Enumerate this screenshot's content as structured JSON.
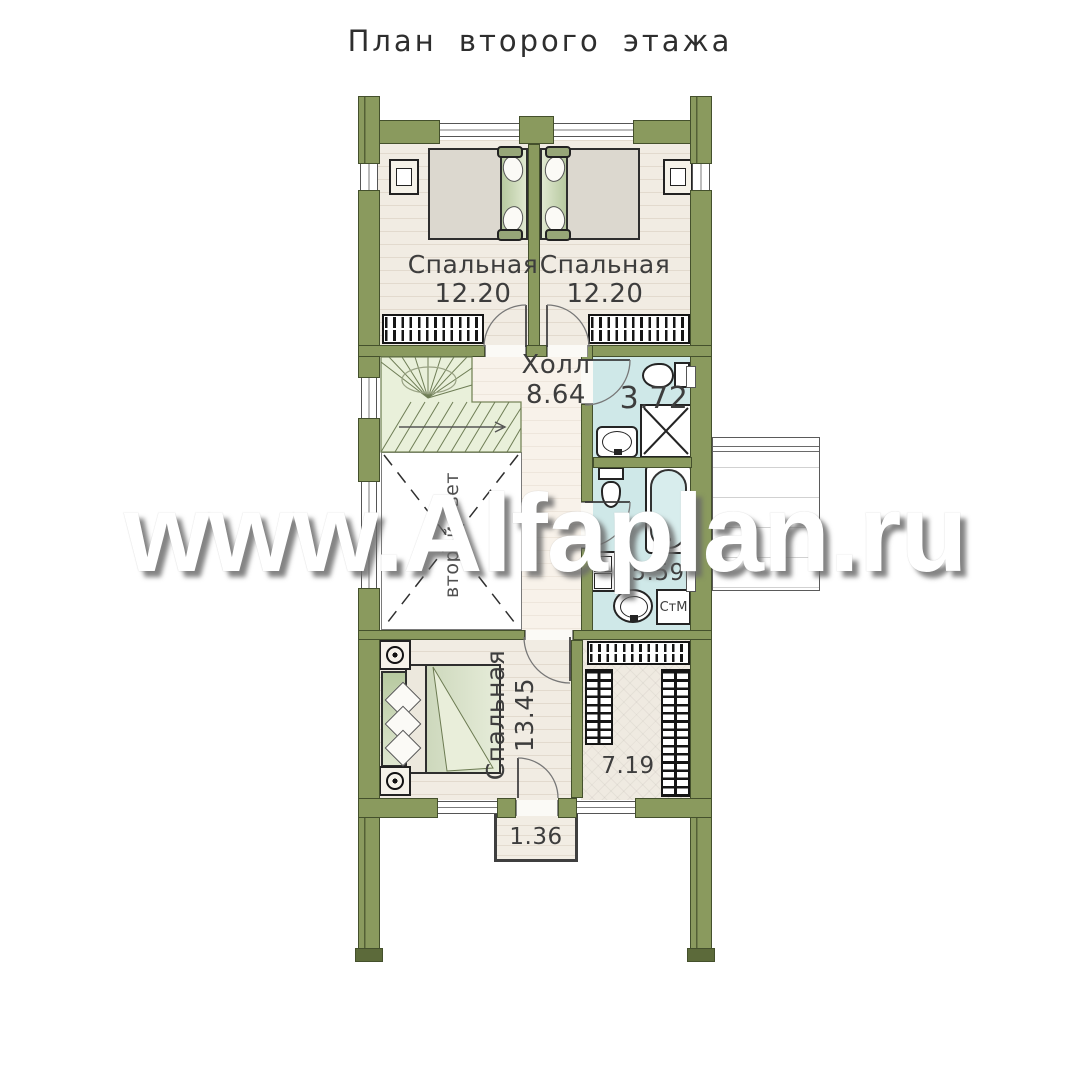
{
  "title": "План второго этажа",
  "watermark": "www.Alfaplan.ru",
  "rooms": {
    "bedroom_top_left": {
      "label": "Спальная",
      "area": "12.20"
    },
    "bedroom_top_right": {
      "label": "Спальная",
      "area": "12.20"
    },
    "hall": {
      "label": "Холл",
      "area": "8.64"
    },
    "bathroom_upper": {
      "area": "3.72"
    },
    "bathroom_lower": {
      "area": "5.59",
      "appliance_label": "СтМ"
    },
    "bedroom_lower": {
      "label": "Спальная",
      "area": "13.45"
    },
    "wardrobe": {
      "area": "7.19"
    },
    "balcony": {
      "area": "1.36"
    },
    "void": {
      "label": "второй свет"
    }
  },
  "colors": {
    "wall_fill": "#8a9a5e",
    "wall_outline": "#44502c",
    "bathroom_floor": "#cfe8e8",
    "stair_fill": "#e9f0da",
    "bedroom_floor": "#f1ece3",
    "hall_floor": "#f8f2ea",
    "headboard_green": "#b7c9a0",
    "hatch_black": "#151515",
    "label_text": "#3d3d3d",
    "watermark_shadow": "#696969"
  }
}
